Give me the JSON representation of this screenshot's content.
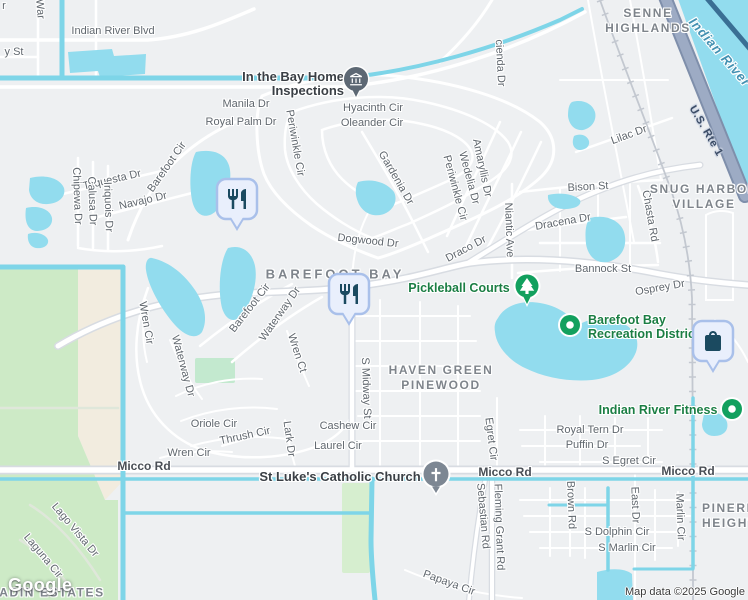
{
  "logo": "Google",
  "attribution": "Map data ©2025 Google",
  "colors": {
    "land": "#eef0f2",
    "water": "#92dcee",
    "canal": "#7ed5e8",
    "park": "#cdeac6",
    "park_small": "#c3e9cf",
    "sand": "#f2ecdf",
    "road": "#ffffff",
    "highway": "#9dabc4",
    "rail": "#c3c8d0",
    "poi_green": "#12a05e",
    "poi_text": "#1b7e44",
    "pin_bg": "#e9effc",
    "pin_border": "#a9c0ea",
    "pin_glyph": "#1b4a60",
    "church_gray": "#7d8793",
    "inspection_slate": "#5d6874"
  },
  "areas": {
    "senne_highlands": "SENNE HIGHLANDS",
    "snug_harbor_village": "SNUG HARBOR VILLAGE",
    "barefoot_bay": "BAREFOOT BAY",
    "haven_green_pinewood": "HAVEN GREEN PINEWOOD",
    "pineridge_heights": "PINERIDGE HEIGHTS",
    "adin_estates": "ADIN ESTATES"
  },
  "water_labels": {
    "indian_river": "Indian River"
  },
  "roads_major": {
    "us_rte_1": "U.S. Rte 1",
    "micco_rd": "Micco Rd"
  },
  "pois": {
    "pickleball": "Pickleball Courts",
    "rec_district": "Barefoot Bay Recreation District",
    "fitness": "Indian River Fitness",
    "inspections": "In the Bay Home Inspections",
    "st_lukes": "St Luke's Catholic Church"
  },
  "icons": {
    "restaurant": "fork-and-knife",
    "shopping": "shopping-bag",
    "park": "tree",
    "church": "cross",
    "inspections": "building-columns",
    "poi_dot": "white-dot"
  },
  "streets": {
    "partial_r": "r",
    "war": "War",
    "y_st": "y St",
    "indian_river_blvd": "Indian River Blvd",
    "hacienda_dr": "cienda Dr",
    "manila_dr": "Manila Dr",
    "royal_palm_dr": "Royal Palm Dr",
    "hyacinth_cir": "Hyacinth Cir",
    "oleander_cir": "Oleander Cir",
    "periwinkle_cir": "Periwinkle Cir",
    "lilac_dr": "Lilac Dr",
    "gardenia_dr": "Gardenia Dr",
    "amaryllis_dr": "Amaryllis Dr",
    "wedelia_dr": "Wedelia Dr",
    "tequesta_dr": "Tequesta Dr",
    "navajo_dr": "Navajo Dr",
    "chipewa_dr": "Chipewa Dr",
    "calusa_dr": "Calusa Dr",
    "iriquois_dr": "Iriquois Dr",
    "barefoot_cir": "Barefoot Cir",
    "bison_st": "Bison St",
    "dracena_dr": "Dracena Dr",
    "chasta_rd": "Chasta Rd",
    "niantic_ave": "Niantic Ave",
    "draco_dr": "Draco Dr",
    "dogwood_dr": "Dogwood Dr",
    "bannock_st": "Bannock St",
    "osprey_dr": "Osprey Dr",
    "waterway_dr": "Waterway Dr",
    "wren_cir": "Wren Cir",
    "wren_ct": "Wren Ct",
    "s_midway_st": "S Midway St",
    "cashew_cir": "Cashew Cir",
    "laurel_cir": "Laurel Cir",
    "lark_dr": "Lark Dr",
    "oriole_cir": "Oriole Cir",
    "thrush_cir": "Thrush Cir",
    "royal_tern_dr": "Royal Tern Dr",
    "puffin_dr": "Puffin Dr",
    "s_egret_cir": "S Egret Cir",
    "egret_cir": "Egret Cir",
    "fleming_grant_rd": "Fleming Grant Rd",
    "sebastian_rd": "Sebastian Rd",
    "brown_rd": "Brown Rd",
    "east_dr": "East Dr",
    "marlin_cir": "Marlin Cir",
    "s_dolphin_cir": "S Dolphin Cir",
    "s_marlin_cir": "S Marlin Cir",
    "papaya_cir": "Papaya Cir",
    "lago_vista_dr": "Lago Vista Dr",
    "laguna_cir": "Laguna Cir"
  }
}
